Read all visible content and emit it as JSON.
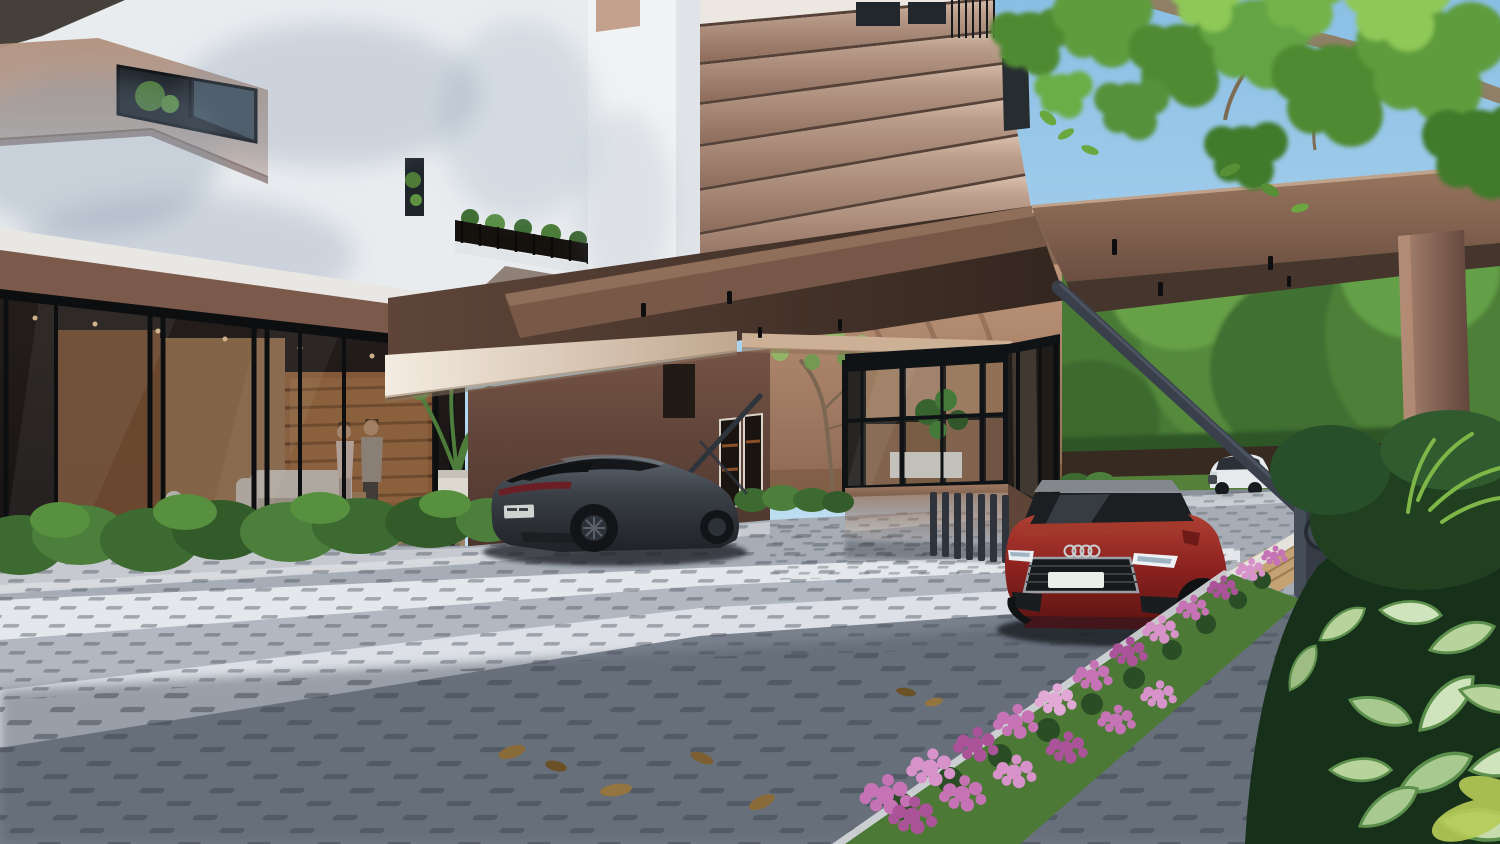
{
  "scene": {
    "type": "3d-architectural-exterior-render",
    "description": "Daytime photorealistic rendering of a modern mid-rise residential building entrance: a long brown porte-cochere canopy with a diagonal stay over a paved drop-off driveway, a glass lobby with two residents inside, a glazed security booth, a raised boom barrier, a dark grey sedan and a red sedan in the driveway, a white SUV on the road beyond a dark perimeter fence, and lush tropical planting with pink flowers in the foreground under an overhanging tree branch.",
    "time_of_day": "day",
    "weather": "sunny",
    "people_count": 2
  },
  "objects": {
    "building": "white and taupe residential tower with stacked balcony bands",
    "entrance_canopy": "flat brown canopy with recessed downlights, end column and diagonal stay",
    "lobby": "double-height glass lobby, warm wood interior, sofa, shelving, two people walking",
    "security_booth": "black-framed glass guard booth with interior plant and louvred base",
    "boom_barrier": "raised dark grey barrier arm with pivot cabinet",
    "car_dark_sedan": "dark grey sports sedan, rear three-quarter view",
    "car_red_sedan": "red sedan with blank white number plate, front view",
    "car_white_suv": "white SUV on the background road",
    "paving": "grey interlocking I-shaped concrete pavers with sun and shadow bands",
    "landscaping": "clipped hedges, courtyard tree, pink flower bed, variegated foliage, lawn"
  },
  "palette": {
    "sky": "#9fcdea",
    "facade_white": "#eceff2",
    "facade_taupe": "#b29482",
    "canopy_brown": "#7c5c4a",
    "canopy_soffit": "#3a2c23",
    "soffit_light": "#f0e7da",
    "beige_wall": "#bb9376",
    "mauve_wall": "#6d4c40",
    "fence_wall": "#362a21",
    "back_road": "#8d939b",
    "back_grass": "#55803a",
    "ground_base": "#a6adb6",
    "walk_strip": "#c6cad0",
    "paver_white": "#e7eaee",
    "paver_shadow": "#5a6270",
    "hedge_green": "#3c6a31",
    "foliage_dark": "#1f3d20",
    "foliage_light": "#79b24a",
    "flower_pink": "#c673b5",
    "grass_green": "#4c7a36",
    "wood_deck": "#c4a274",
    "suv_body": "#e7eaec",
    "car_red": "#8e2320",
    "car_dark": "#383d44",
    "barrier": "#39404c",
    "pivot_box": "#353c46",
    "glass_dark": "#241f1b",
    "interior_warm": "#b2805a",
    "trunk": "#8f7f66"
  }
}
